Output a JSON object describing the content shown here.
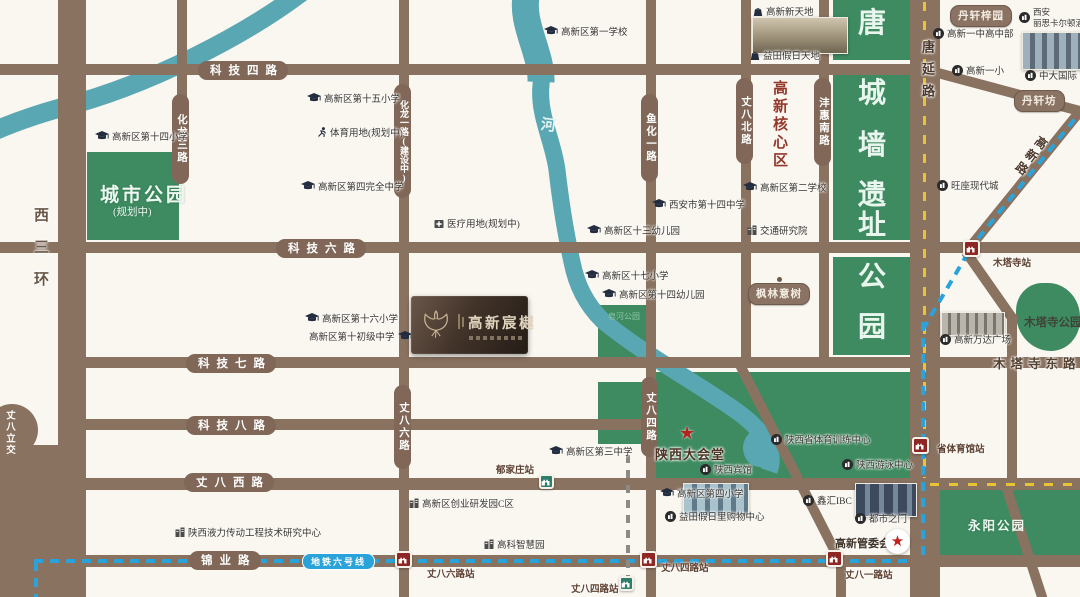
{
  "map": {
    "bg": "#faf7f1",
    "road_color": "#8a7260",
    "park_color": "#3e8b61",
    "river_color": "#58a7b3",
    "metro6_color": "#2aa2da",
    "metro_planned_color": "#8b8b84",
    "station_red": "#8e2623",
    "station_green": "#2f7d6b",
    "yellow_dash": "#e6c435"
  },
  "project": {
    "name": "高新宸樾",
    "logo_icon": "ginkgo-leaf"
  },
  "road_labels_h": [
    {
      "label": "科技四路",
      "x": 198,
      "y": 61
    },
    {
      "label": "科技六路",
      "x": 276,
      "y": 239
    },
    {
      "label": "科技七路",
      "x": 186,
      "y": 354
    },
    {
      "label": "科技八路",
      "x": 186,
      "y": 416
    },
    {
      "label": "丈八西路",
      "x": 184,
      "y": 473
    },
    {
      "label": "锦业路",
      "x": 189,
      "y": 551
    }
  ],
  "road_labels_v": [
    {
      "label": "化龙三路",
      "x": 172,
      "y": 94,
      "h": 90
    },
    {
      "label": "化龙一路(建设中)",
      "x": 394,
      "y": 84,
      "h": 114
    },
    {
      "label": "丈八六路",
      "x": 394,
      "y": 385,
      "h": 84
    },
    {
      "label": "鱼化一路",
      "x": 641,
      "y": 94,
      "h": 88
    },
    {
      "label": "丈八四路",
      "x": 641,
      "y": 377,
      "h": 80
    },
    {
      "label": "丈八北路",
      "x": 736,
      "y": 78,
      "h": 86
    },
    {
      "label": "沣惠南路",
      "x": 814,
      "y": 78,
      "h": 88
    }
  ],
  "road_names": {
    "xisanhuan": "西三环",
    "tangyanlu": "唐延路",
    "gaoxinlu": "高新路",
    "mutasidonglu": "木塔寺东路",
    "zhangbalijiao": "丈八立交",
    "metro_line6": "地铁六号线"
  },
  "areas": {
    "city_park": "城市公园",
    "city_park_sub": "(规划中)",
    "tang_wall_park": "唐城墙遗址公园",
    "gaoxin_core": "高新核心区",
    "zaohe_park": "皂河公园",
    "yongyang_park": "永阳公园",
    "mutasi_park": "木塔寺公园",
    "river_char": "河"
  },
  "badges": [
    {
      "label": "丹轩梓园",
      "x": 950,
      "y": 5,
      "pin": false
    },
    {
      "label": "丹轩坊",
      "x": 1014,
      "y": 90,
      "pin": false
    },
    {
      "label": "枫林意树",
      "x": 748,
      "y": 283,
      "pin": true
    }
  ],
  "pois": [
    {
      "label": "高新区第十四小学",
      "icon": "school",
      "x": 95,
      "y": 129
    },
    {
      "label": "高新区第十五小学",
      "icon": "school",
      "x": 307,
      "y": 91
    },
    {
      "label": "高新区第一学校",
      "icon": "school",
      "x": 544,
      "y": 24
    },
    {
      "label": "高新区第四完全中学",
      "icon": "school",
      "x": 301,
      "y": 179
    },
    {
      "label": "高新区第十六小学",
      "icon": "school",
      "x": 305,
      "y": 311
    },
    {
      "label": "高新区第十初级中学",
      "icon": "school",
      "x": 309,
      "y": 329,
      "side": "right"
    },
    {
      "label": "高新区十三幼儿园",
      "icon": "school",
      "x": 587,
      "y": 223
    },
    {
      "label": "西安市第十四中学",
      "icon": "school",
      "x": 652,
      "y": 197
    },
    {
      "label": "高新区第二学校",
      "icon": "school",
      "x": 743,
      "y": 180
    },
    {
      "label": "高新区十七小学",
      "icon": "school",
      "x": 585,
      "y": 268
    },
    {
      "label": "高新区第十四幼儿园",
      "icon": "school",
      "x": 602,
      "y": 287
    },
    {
      "label": "高新区第三中学",
      "icon": "school",
      "x": 549,
      "y": 444
    },
    {
      "label": "高新区第四小学",
      "icon": "school",
      "x": 660,
      "y": 486
    },
    {
      "label": "交通研究院",
      "icon": "building",
      "x": 747,
      "y": 223
    },
    {
      "label": "医疗用地(规划中)",
      "icon": "hospital",
      "x": 434,
      "y": 216
    },
    {
      "label": "体育用地(规划中)",
      "icon": "runner",
      "x": 317,
      "y": 125
    },
    {
      "label": "高新区创业研发园C区",
      "icon": "building",
      "x": 409,
      "y": 496
    },
    {
      "label": "高科智慧园",
      "icon": "building",
      "x": 484,
      "y": 537
    },
    {
      "label": "陕西液力传动工程技术研究中心",
      "icon": "building",
      "x": 175,
      "y": 525
    },
    {
      "label": "高新新天地",
      "icon": "bag",
      "x": 753,
      "y": 4
    },
    {
      "label": "益田假日天地",
      "icon": "bag",
      "x": 750,
      "y": 48
    },
    {
      "label": "旺座现代城",
      "icon": "circle",
      "x": 937,
      "y": 178
    },
    {
      "label": "鑫汇IBC",
      "icon": "circle",
      "x": 803,
      "y": 493
    },
    {
      "label": "益田假日里购物中心",
      "icon": "circle",
      "x": 665,
      "y": 509
    },
    {
      "label": "都市之门",
      "icon": "circle",
      "x": 855,
      "y": 511
    },
    {
      "label": "陕西宾馆",
      "icon": "circle",
      "x": 700,
      "y": 462
    },
    {
      "label": "陕西省体育训练中心",
      "icon": "circle",
      "x": 771,
      "y": 432
    },
    {
      "label": "陕西游泳中心",
      "icon": "circle",
      "x": 842,
      "y": 457
    },
    {
      "label": "中大国际",
      "icon": "circle",
      "x": 1025,
      "y": 68
    },
    {
      "label": "高新一小",
      "icon": "circle",
      "x": 952,
      "y": 63
    },
    {
      "label": "高新一中高中部",
      "icon": "circle",
      "x": 933,
      "y": 26
    },
    {
      "label": "西安丽思卡尔顿酒店",
      "icon": "circle",
      "x": 1019,
      "y": 7,
      "lines": [
        "西安",
        "丽思卡尔顿酒店"
      ]
    },
    {
      "label": "高新万达广场",
      "icon": "circle",
      "x": 940,
      "y": 332
    },
    {
      "label": "高新管委会",
      "icon": "none",
      "x": 835,
      "y": 535,
      "cls": "poi-bold"
    },
    {
      "label": "陕西大会堂",
      "icon": "none",
      "x": 655,
      "y": 444,
      "cls": "poi-hall"
    }
  ],
  "stations_red": [
    {
      "name": "丈八六路站",
      "ix": 395,
      "iy": 551,
      "lx": 427,
      "ly": 566
    },
    {
      "name": "丈八四路站",
      "ix": 640,
      "iy": 551,
      "lx": 661,
      "ly": 560
    },
    {
      "name": "丈八一路站",
      "ix": 826,
      "iy": 550,
      "lx": 845,
      "ly": 567
    },
    {
      "name": "省体育馆站",
      "ix": 912,
      "iy": 437,
      "lx": 937,
      "ly": 441
    },
    {
      "name": "木塔寺站",
      "ix": 963,
      "iy": 240,
      "lx": 993,
      "ly": 255
    }
  ],
  "stations_green": [
    {
      "name": "郁家庄站",
      "ix": 539,
      "iy": 474,
      "lx": 496,
      "ly": 462
    },
    {
      "name": "丈八四路站",
      "ix": 619,
      "iy": 576,
      "lx": 571,
      "ly": 581
    }
  ]
}
